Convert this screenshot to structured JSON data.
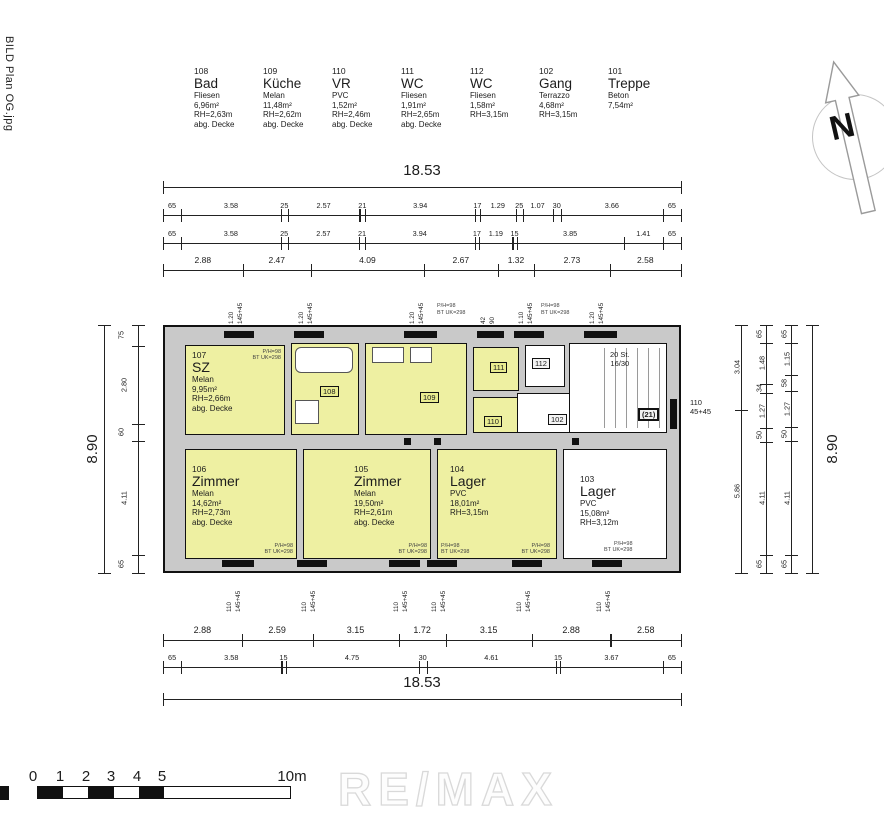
{
  "file_label": "BILD Plan OG.jpg",
  "watermark": "RE/MAX",
  "north": {
    "letter": "N"
  },
  "legend": {
    "rooms": [
      {
        "num": "108",
        "name": "Bad",
        "l1": "Fliesen",
        "l2": "6,96m²",
        "l3": "RH=2,63m",
        "l4": "abg. Decke"
      },
      {
        "num": "109",
        "name": "Küche",
        "l1": "Melan",
        "l2": "11,48m²",
        "l3": "RH=2,62m",
        "l4": "abg. Decke"
      },
      {
        "num": "110",
        "name": "VR",
        "l1": "PVC",
        "l2": "1,52m²",
        "l3": "RH=2,46m",
        "l4": "abg. Decke"
      },
      {
        "num": "111",
        "name": "WC",
        "l1": "Fliesen",
        "l2": "1,91m²",
        "l3": "RH=2,65m",
        "l4": "abg. Decke"
      },
      {
        "num": "112",
        "name": "WC",
        "l1": "Fliesen",
        "l2": "1,58m²",
        "l3": "RH=3,15m",
        "l4": ""
      },
      {
        "num": "102",
        "name": "Gang",
        "l1": "Terrazzo",
        "l2": "4,68m²",
        "l3": "RH=3,15m",
        "l4": ""
      },
      {
        "num": "101",
        "name": "Treppe",
        "l1": "Beton",
        "l2": "7,54m²",
        "l3": "",
        "l4": ""
      }
    ]
  },
  "dims": {
    "top": {
      "overall": [
        "18.53"
      ],
      "row1": [
        "65",
        "3.58",
        "25",
        "2.57",
        "21",
        "3.94",
        "17",
        "1.29",
        "25",
        "1.07",
        "30",
        "3.66",
        "65"
      ],
      "row2": [
        "65",
        "3.58",
        "25",
        "2.57",
        "21",
        "3.94",
        "17",
        "1.19",
        "15",
        "3.85",
        "1.41",
        "65"
      ],
      "row3": [
        "2.88",
        "2.47",
        "4.09",
        "2.67",
        "1.32",
        "2.73",
        "2.58"
      ]
    },
    "bottom": {
      "row1": [
        "2.88",
        "2.59",
        "3.15",
        "1.72",
        "3.15",
        "2.88",
        "2.58"
      ],
      "row2": [
        "65",
        "3.58",
        "15",
        "4.75",
        "30",
        "4.61",
        "15",
        "3.67",
        "65"
      ],
      "overall": [
        "18.53"
      ]
    },
    "left": {
      "overall": [
        "8.90"
      ],
      "chain": [
        "75",
        "2.80",
        "60",
        "4.11",
        "65"
      ]
    },
    "right": {
      "chain1": [
        "3.04",
        "5.86"
      ],
      "chain2": [
        "65",
        "1.48",
        "34",
        "1.27",
        "50",
        "4.11",
        "65"
      ],
      "chain3": [
        "65",
        "1.15",
        "58",
        "1.27",
        "50",
        "4.11",
        "65"
      ],
      "overall": [
        "8.90"
      ]
    }
  },
  "plan": {
    "room107": {
      "num": "107",
      "name": "SZ",
      "l1": "Melan",
      "l2": "9,95m²",
      "l3": "RH=2,66m",
      "l4": "abg. Decke"
    },
    "room106": {
      "num": "106",
      "name": "Zimmer",
      "l1": "Melan",
      "l2": "14,62m²",
      "l3": "RH=2,73m",
      "l4": "abg. Decke"
    },
    "room105": {
      "num": "105",
      "name": "Zimmer",
      "l1": "Melan",
      "l2": "19,50m²",
      "l3": "RH=2,61m",
      "l4": "abg. Decke"
    },
    "room104": {
      "num": "104",
      "name": "Lager",
      "l1": "PVC",
      "l2": "18,01m²",
      "l3": "RH=3,15m",
      "l4": ""
    },
    "room103": {
      "num": "103",
      "name": "Lager",
      "l1": "PVC",
      "l2": "15,08m²",
      "l3": "RH=3,12m",
      "l4": ""
    },
    "tags": {
      "t108": "108",
      "t109": "109",
      "t110": "110",
      "t111": "111",
      "t112": "112",
      "t102": "102"
    },
    "stair": {
      "note1": "20 St.",
      "note2": "16/30",
      "tag": "(21)"
    },
    "note1": "P/H=98",
    "note2": "BT UK=298",
    "right_window": {
      "a": "110",
      "b": "45+45"
    },
    "windows_top": [
      {
        "a": "1.20",
        "b": "145+45"
      },
      {
        "a": "1.20",
        "b": "145+45"
      },
      {
        "a": "1.20",
        "b": "145+45"
      },
      {
        "a": "42",
        "b": "90"
      },
      {
        "a": "1.10",
        "b": "145+45"
      },
      {
        "a": "1.20",
        "b": "145+45"
      }
    ],
    "windows_bottom": [
      {
        "a": "110",
        "b": "145+45"
      },
      {
        "a": "110",
        "b": "145+45"
      },
      {
        "a": "110",
        "b": "145+45"
      },
      {
        "a": "110",
        "b": "145+45"
      },
      {
        "a": "110",
        "b": "145+45"
      },
      {
        "a": "110",
        "b": "145+45"
      }
    ]
  },
  "scalebar": {
    "ticks": [
      "0",
      "1",
      "2",
      "3",
      "4",
      "5"
    ],
    "end": "10m"
  }
}
